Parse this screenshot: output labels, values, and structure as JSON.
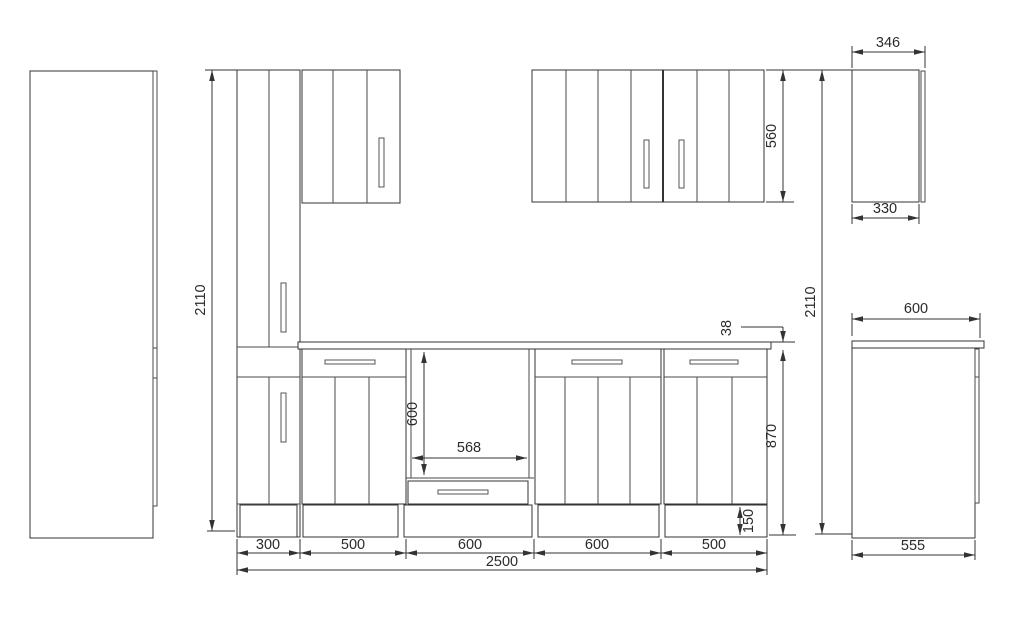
{
  "drawing": {
    "title": "kitchen-cabinet-dimension-drawing",
    "colors": {
      "line": "#333333",
      "text": "#2a2a2a",
      "background": "#ffffff"
    }
  },
  "dims": {
    "total_height_left": "2110",
    "total_height_right": "2110",
    "wall_cabinet_height": "560",
    "wall_side_depth_top": "346",
    "wall_side_depth_bottom": "330",
    "worktop_thickness": "38",
    "base_height": "870",
    "plinth_height": "150",
    "oven_niche_width": "568",
    "oven_niche_height": "600",
    "base_side_depth_top": "600",
    "base_side_depth_bottom": "555",
    "segment_1": "300",
    "segment_2": "500",
    "segment_3": "600",
    "segment_4": "600",
    "segment_5": "500",
    "total_width": "2500"
  }
}
